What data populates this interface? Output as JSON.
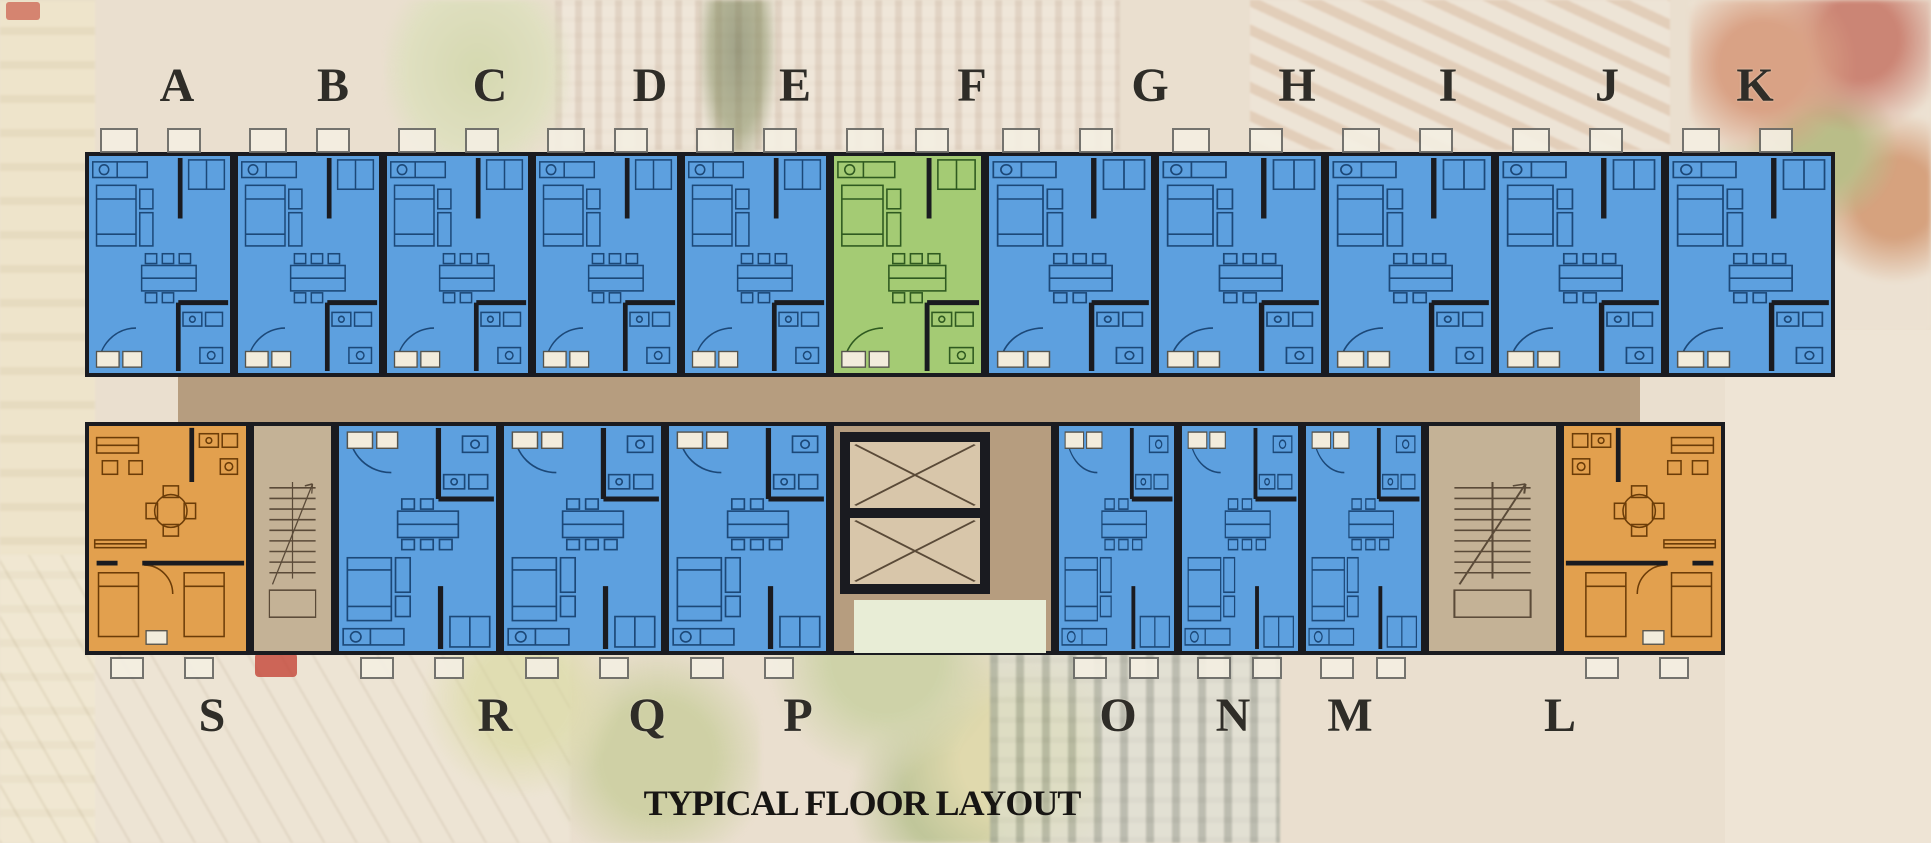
{
  "title": "TYPICAL FLOOR LAYOUT",
  "colors": {
    "background": "#eadfcf",
    "unit_blue": "#5da0df",
    "unit_green": "#a4cb74",
    "unit_orange": "#e2a04e",
    "stroke_blue": "#1c4878",
    "stroke_green": "#2f5a20",
    "stroke_orange": "#6b3c08",
    "wall": "#1a1b20",
    "corridor": "#b69d7f",
    "stair_fill": "#c4b296",
    "shaft_fill": "#d8c6aa",
    "lobby_opening": "#e8edd6",
    "white_box": "#f2ecdc",
    "letter_color": "#2f2d28"
  },
  "floor_plan": {
    "top_labels": [
      {
        "label": "A",
        "x": 177
      },
      {
        "label": "B",
        "x": 333
      },
      {
        "label": "C",
        "x": 490
      },
      {
        "label": "D",
        "x": 650
      },
      {
        "label": "E",
        "x": 795
      },
      {
        "label": "F",
        "x": 972
      },
      {
        "label": "G",
        "x": 1150
      },
      {
        "label": "H",
        "x": 1297
      },
      {
        "label": "I",
        "x": 1448
      },
      {
        "label": "J",
        "x": 1607
      },
      {
        "label": "K",
        "x": 1755
      }
    ],
    "bottom_labels": [
      {
        "label": "S",
        "x": 212
      },
      {
        "label": "R",
        "x": 495
      },
      {
        "label": "Q",
        "x": 647
      },
      {
        "label": "P",
        "x": 798
      },
      {
        "label": "O",
        "x": 1118
      },
      {
        "label": "N",
        "x": 1233
      },
      {
        "label": "M",
        "x": 1350
      },
      {
        "label": "L",
        "x": 1560
      }
    ],
    "top_row": {
      "y": 152,
      "h": 225,
      "units": [
        {
          "id": "A",
          "x": 85,
          "w": 149,
          "color": "blue"
        },
        {
          "id": "B",
          "x": 234,
          "w": 149,
          "color": "blue"
        },
        {
          "id": "C",
          "x": 383,
          "w": 149,
          "color": "blue"
        },
        {
          "id": "D",
          "x": 532,
          "w": 149,
          "color": "blue"
        },
        {
          "id": "E",
          "x": 681,
          "w": 149,
          "color": "blue"
        },
        {
          "id": "F",
          "x": 830,
          "w": 155,
          "color": "green"
        },
        {
          "id": "G",
          "x": 985,
          "w": 170,
          "color": "blue"
        },
        {
          "id": "H",
          "x": 1155,
          "w": 170,
          "color": "blue"
        },
        {
          "id": "I",
          "x": 1325,
          "w": 170,
          "color": "blue"
        },
        {
          "id": "J",
          "x": 1495,
          "w": 170,
          "color": "blue"
        },
        {
          "id": "K",
          "x": 1665,
          "w": 170,
          "color": "blue"
        }
      ]
    },
    "bottom_row": {
      "y": 422,
      "h": 233,
      "units": [
        {
          "id": "S",
          "x": 85,
          "w": 165,
          "color": "orange",
          "kind": "corner"
        },
        {
          "id": "stair-left",
          "x": 250,
          "w": 85,
          "kind": "stair"
        },
        {
          "id": "R",
          "x": 335,
          "w": 165,
          "color": "blue",
          "kind": "studio"
        },
        {
          "id": "Q",
          "x": 500,
          "w": 165,
          "color": "blue",
          "kind": "studio"
        },
        {
          "id": "P",
          "x": 665,
          "w": 165,
          "color": "blue",
          "kind": "studio"
        },
        {
          "id": "core",
          "x": 830,
          "w": 225,
          "kind": "core"
        },
        {
          "id": "O",
          "x": 1055,
          "w": 123,
          "color": "blue",
          "kind": "studio"
        },
        {
          "id": "N",
          "x": 1178,
          "w": 124,
          "color": "blue",
          "kind": "studio"
        },
        {
          "id": "M",
          "x": 1302,
          "w": 123,
          "color": "blue",
          "kind": "studio"
        },
        {
          "id": "stair-right",
          "x": 1425,
          "w": 135,
          "kind": "stair"
        },
        {
          "id": "L",
          "x": 1560,
          "w": 165,
          "color": "orange",
          "kind": "corner",
          "mirror": true
        }
      ]
    },
    "corridor": {
      "x": 178,
      "y": 377,
      "w": 1462,
      "h": 45
    }
  }
}
